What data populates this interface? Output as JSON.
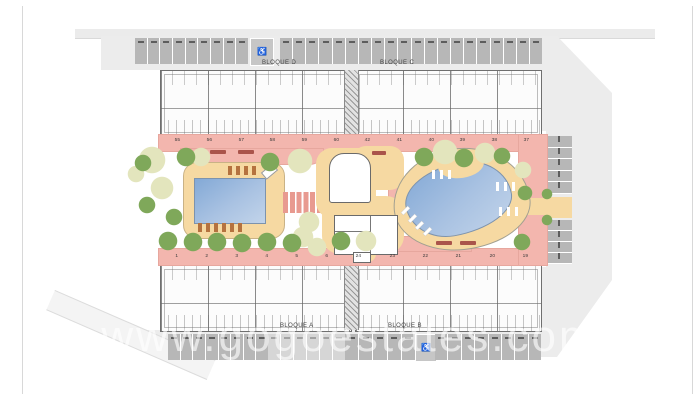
{
  "plan": {
    "watermark": "www.gogoestates.com",
    "blocks": {
      "top_left": "BLOQUE D",
      "top_right": "BLOQUE C",
      "bottom_left": "BLOQUE A",
      "bottom_right": "BLOQUE B"
    },
    "unit_numbers": {
      "top": [
        "55",
        "56",
        "57",
        "58",
        "59",
        "60",
        "42",
        "41",
        "40",
        "39",
        "38",
        "37"
      ],
      "bottom": [
        "1",
        "2",
        "3",
        "4",
        "5",
        "6",
        "24",
        "23",
        "22",
        "21",
        "20",
        "19"
      ]
    },
    "icons": {
      "wheelchair": "♿"
    },
    "colors": {
      "walkway_pink": "#f3b6ae",
      "deck_tan": "#f6d9a2",
      "pool_blue": "#9db9e0",
      "site_gray": "#ececec",
      "parking_gray": "#b7b7b7",
      "tree_green": "#7fa85a",
      "tree_pale": "#e3e5bd"
    }
  }
}
